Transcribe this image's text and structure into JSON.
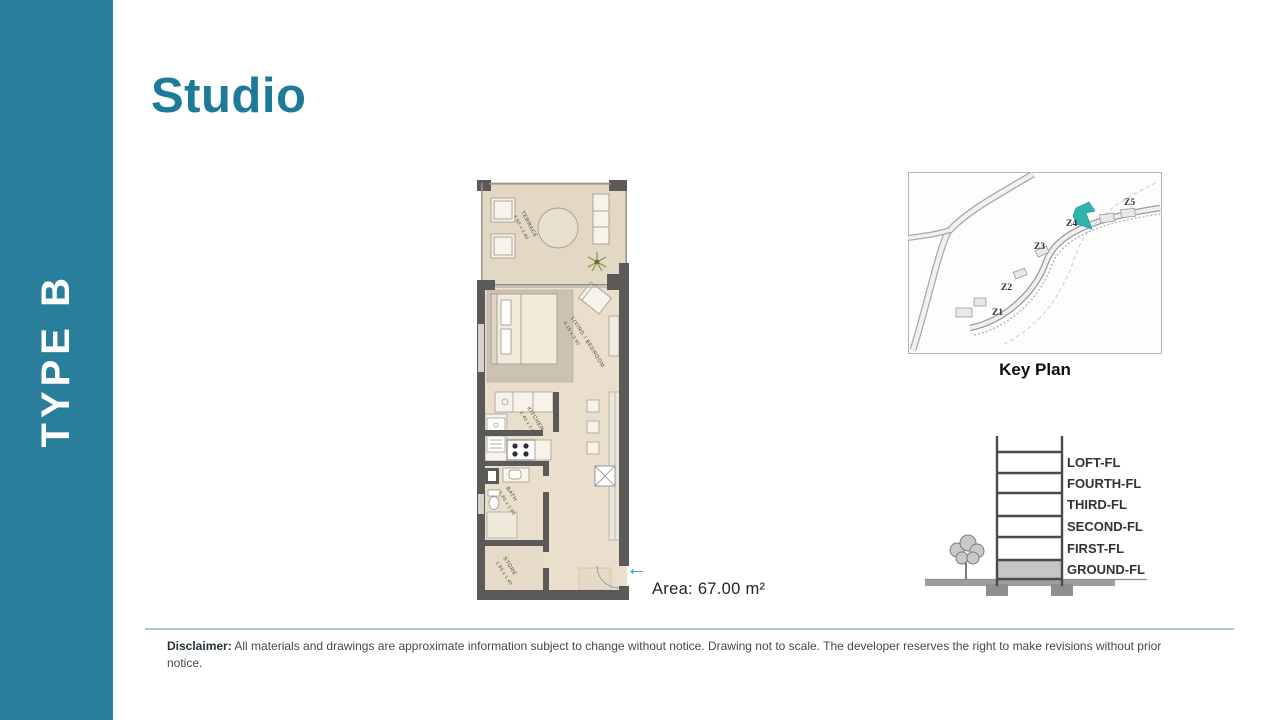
{
  "sidebar": {
    "label": "TYPE B",
    "color": "#287e9b"
  },
  "page": {
    "title": "Studio",
    "title_color": "#1e7a99"
  },
  "floorplan": {
    "rooms": [
      {
        "name": "TERRACE",
        "dims": "4.50 x 2.80"
      },
      {
        "name": "LIVING / BEDROOM",
        "dims": "4.15 x 3.90"
      },
      {
        "name": "KITCHEN",
        "dims": "2.40 x 2.60"
      },
      {
        "name": "BATH",
        "dims": "1.85 x 2.60"
      },
      {
        "name": "STORE",
        "dims": "1.85 x 1.40"
      }
    ],
    "entry_arrow": "←",
    "entry_arrow_color": "#2498c6",
    "area_label": "Area: 67.00 m²"
  },
  "keyplan": {
    "caption": "Key Plan",
    "zones": [
      "Z1",
      "Z2",
      "Z3",
      "Z4",
      "Z5"
    ],
    "highlight_color": "#2fb3ad"
  },
  "section": {
    "floors": [
      "LOFT-FL",
      "FOURTH-FL",
      "THIRD-FL",
      "SECOND-FL",
      "FIRST-FL",
      "GROUND-FL"
    ]
  },
  "disclaimer": {
    "label": "Disclaimer:",
    "text": " All materials and drawings are approximate information subject to change without notice. Drawing not to scale. The developer reserves the right to make revisions without prior notice."
  }
}
